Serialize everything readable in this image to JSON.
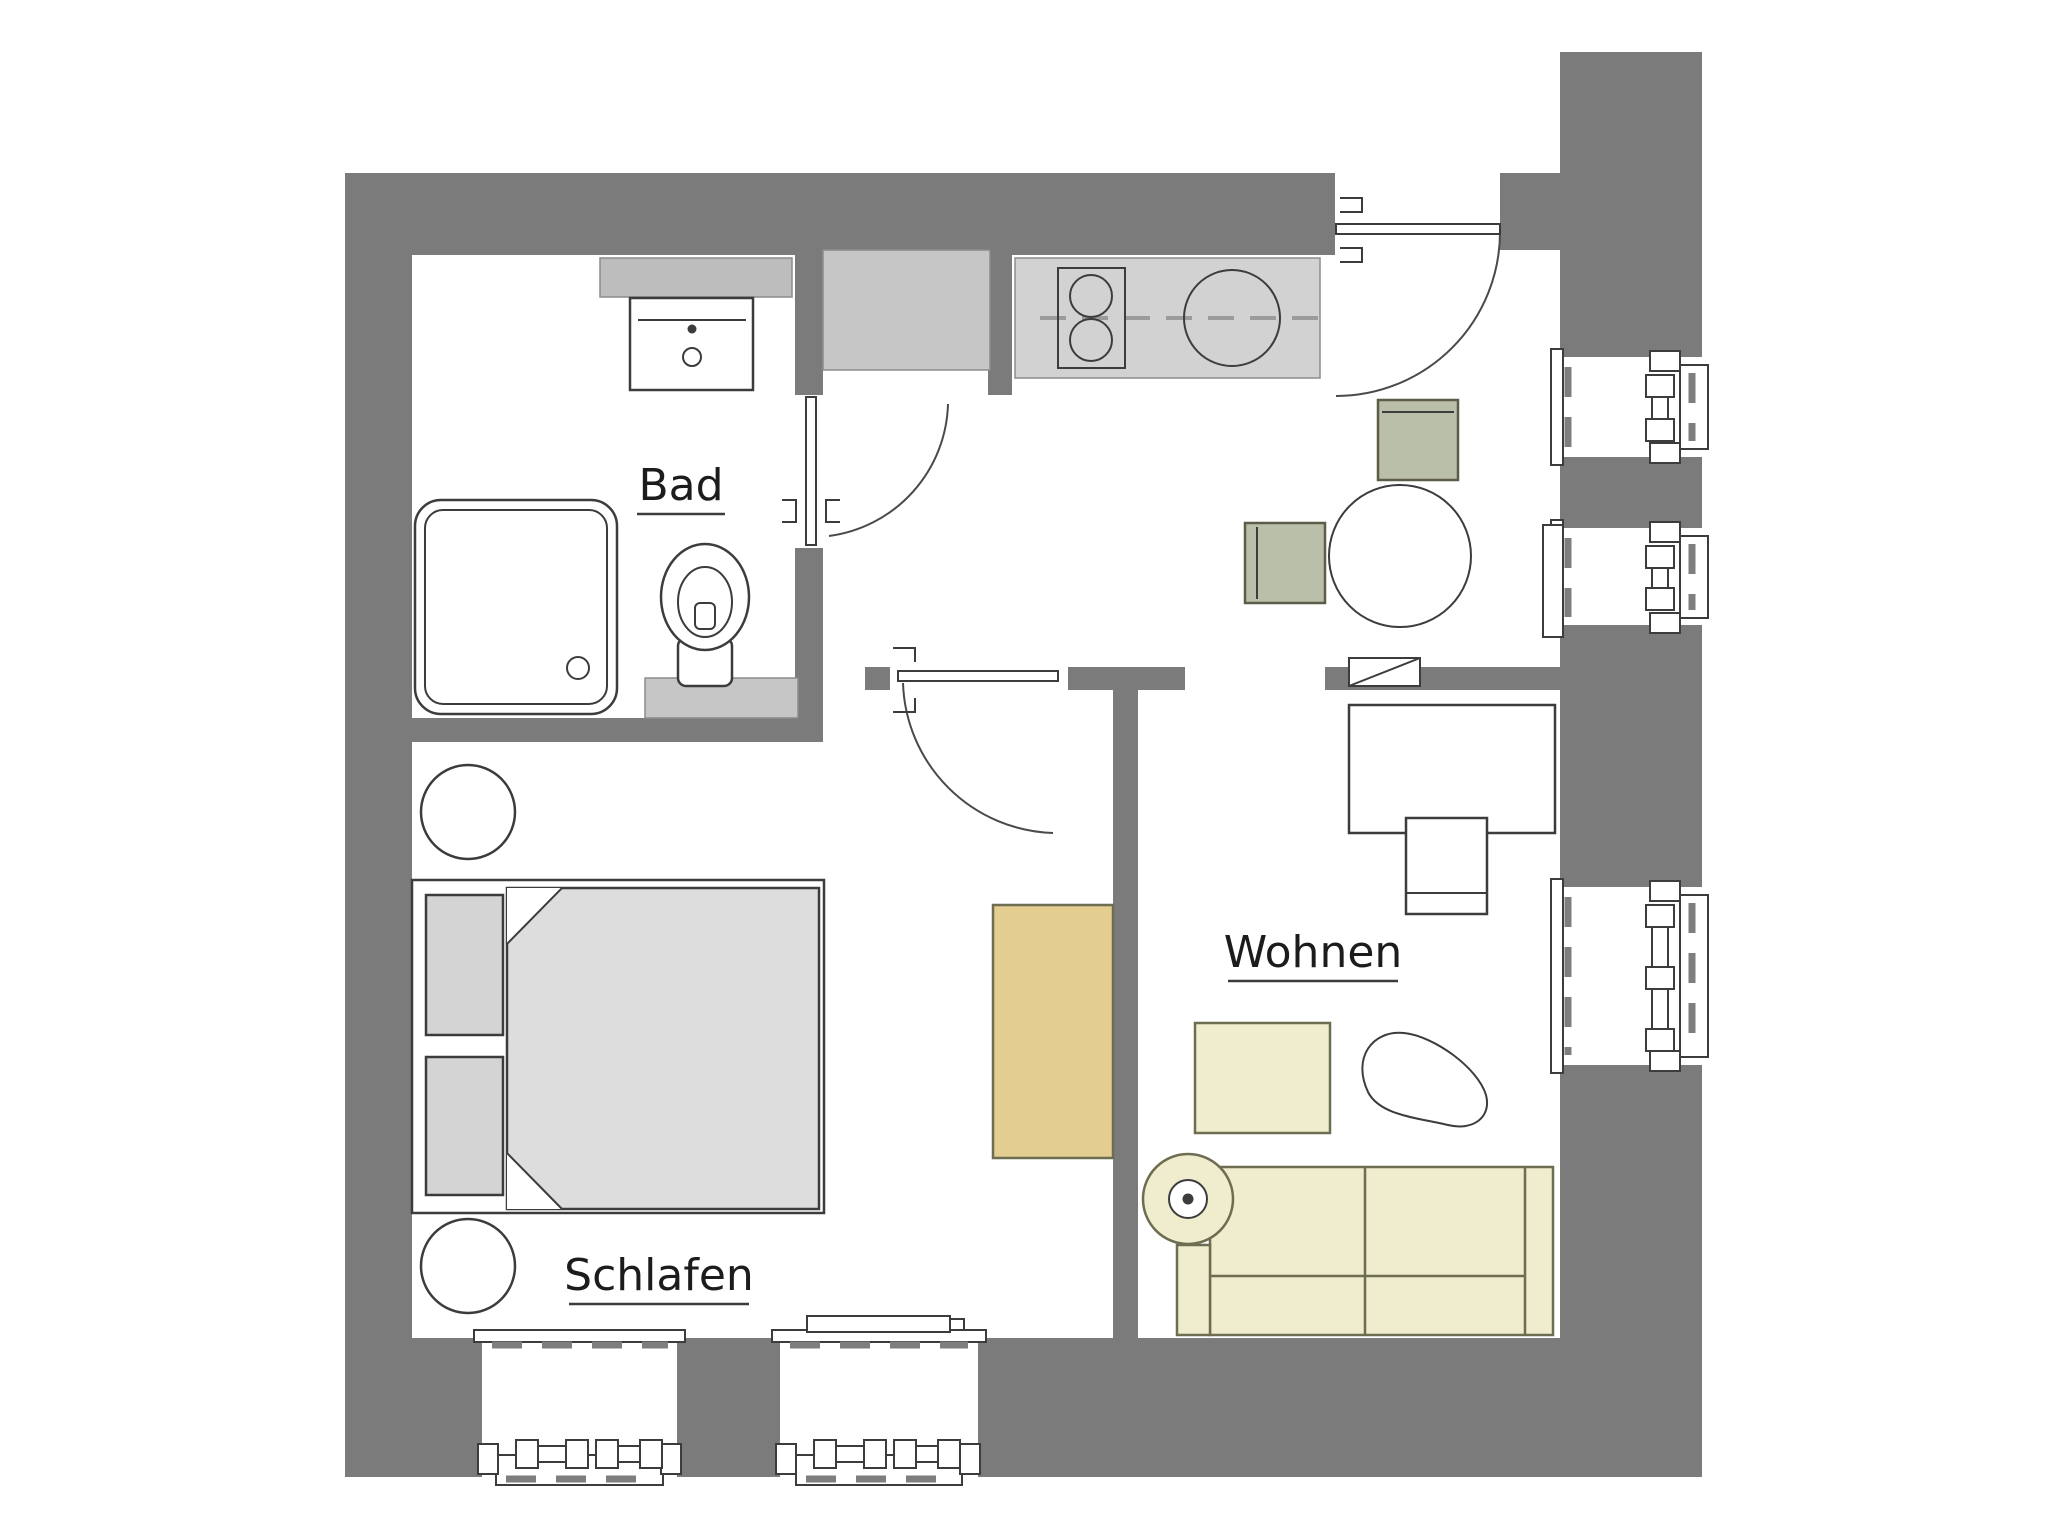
{
  "document": {
    "type": "floor-plan",
    "background": "#ffffff"
  },
  "colors": {
    "wall": "#7b7b7b",
    "fixture_light": "#c6c6c6",
    "counter": "#d2d2d2",
    "shelf": "#bdbdbd",
    "bed": "#dddddd",
    "pillow": "#d4d4d4",
    "sage": "#b9bfa8",
    "cream": "#efedcd",
    "tan": "#e3cd90",
    "line": "#3c3c3c",
    "text": "#1c1c1c"
  },
  "rooms": {
    "bathroom": {
      "label": "Bad"
    },
    "living": {
      "label": "Wohnen"
    },
    "bedroom": {
      "label": "Schlafen"
    }
  }
}
